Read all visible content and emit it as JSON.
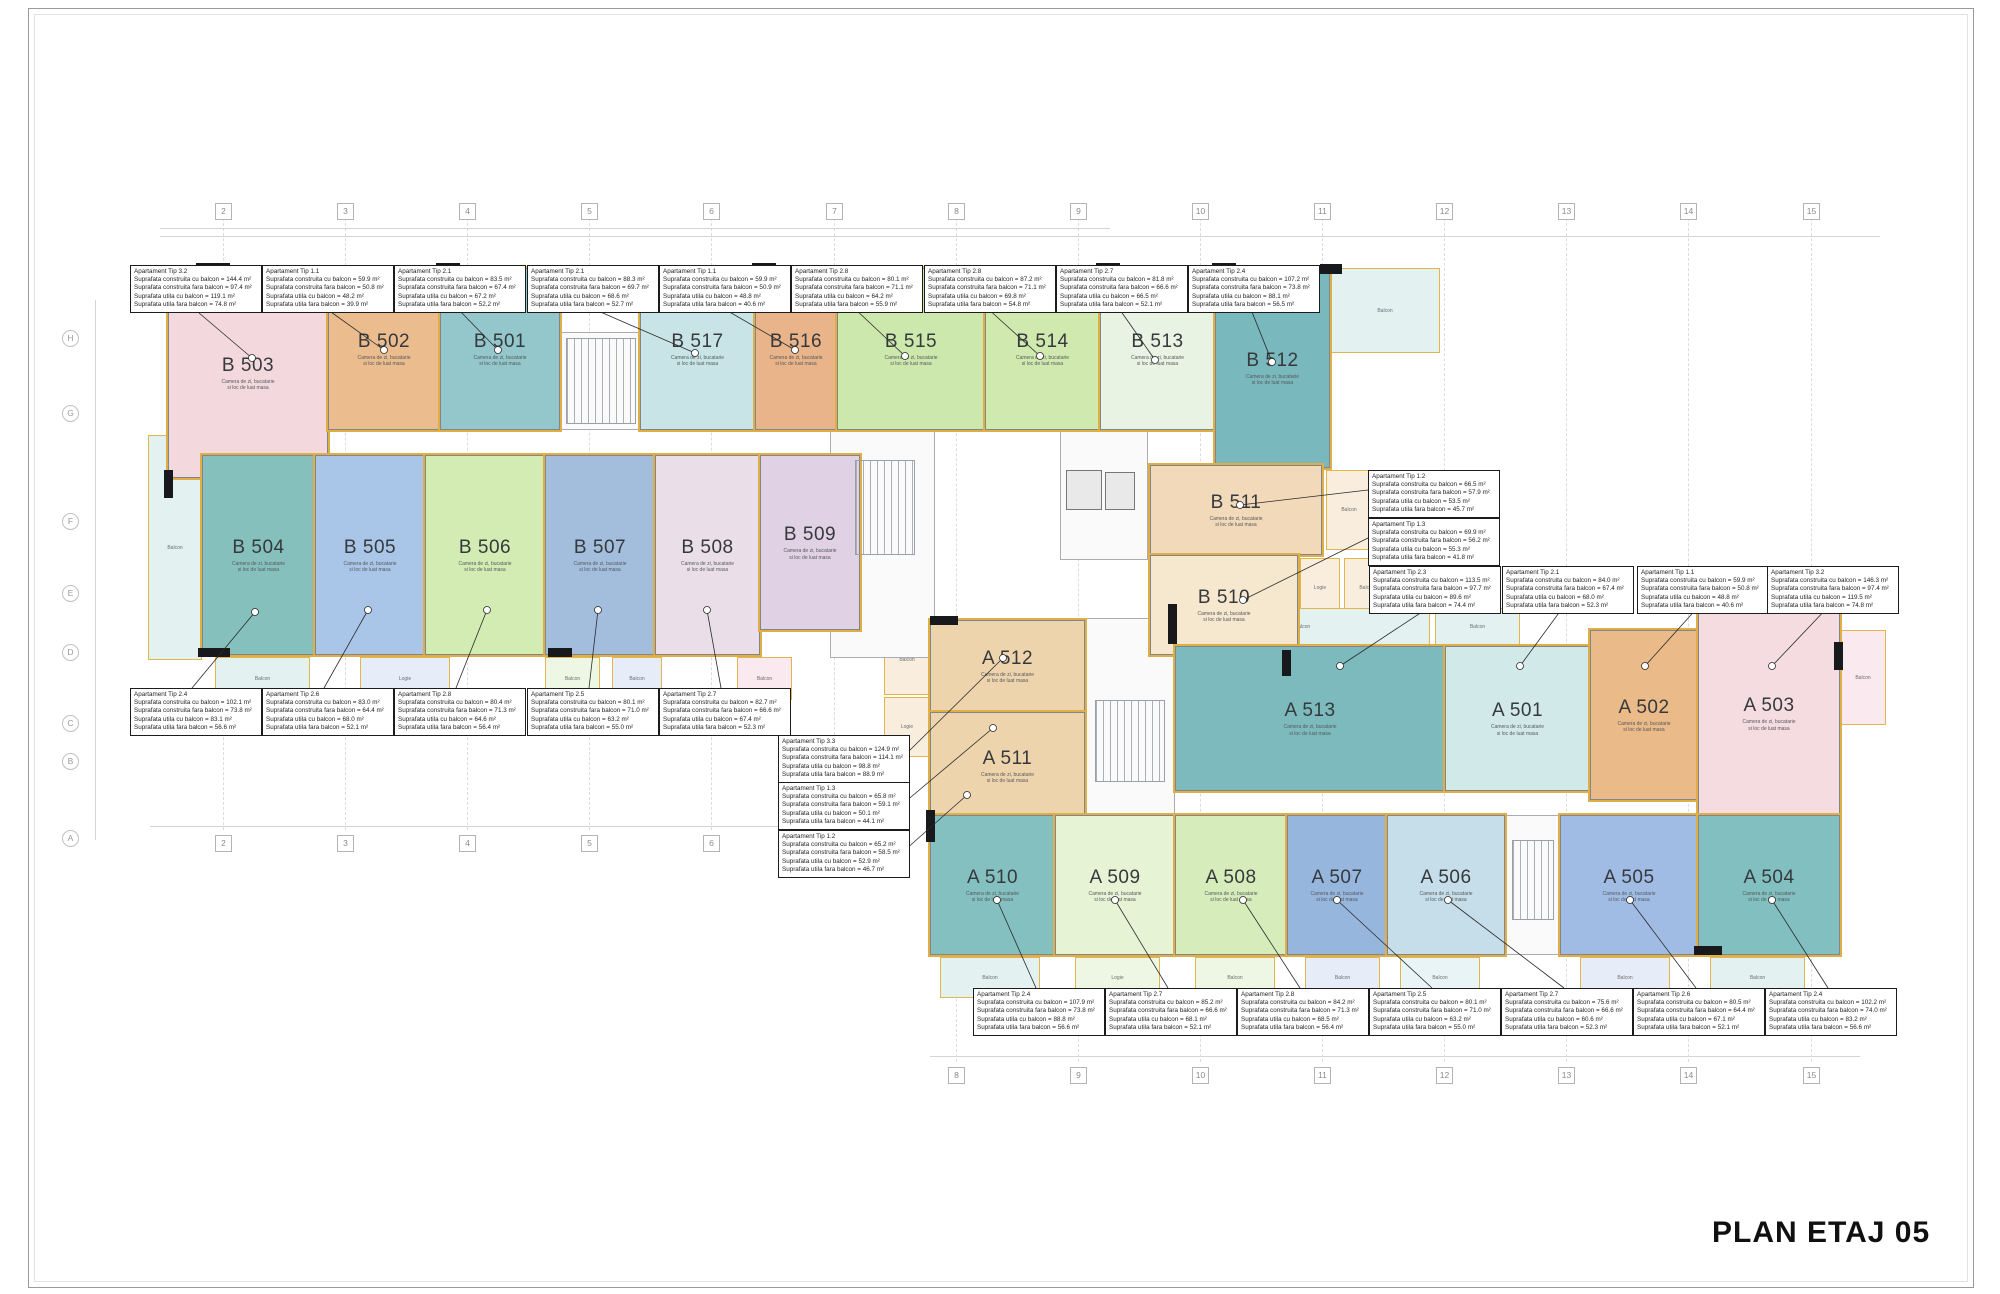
{
  "sheet": {
    "title": "PLAN ETAJ 05"
  },
  "grid": {
    "columns": [
      "2",
      "3",
      "4",
      "5",
      "6",
      "7",
      "8",
      "9",
      "10",
      "11",
      "12",
      "13",
      "14",
      "15"
    ],
    "rows": [
      "H",
      "G",
      "F",
      "E",
      "D",
      "C",
      "B",
      "A"
    ]
  },
  "captions": {
    "living": "Camera de zi, bucatarie\nsi loc de luat masa",
    "balcon": "Balcon",
    "logie": "Logie"
  },
  "units": {
    "b501": {
      "label": "B 501"
    },
    "b502": {
      "label": "B 502"
    },
    "b503": {
      "label": "B 503"
    },
    "b504": {
      "label": "B 504"
    },
    "b505": {
      "label": "B 505"
    },
    "b506": {
      "label": "B 506"
    },
    "b507": {
      "label": "B 507"
    },
    "b508": {
      "label": "B 508"
    },
    "b509": {
      "label": "B 509"
    },
    "b510": {
      "label": "B 510"
    },
    "b511": {
      "label": "B 511"
    },
    "b512": {
      "label": "B 512"
    },
    "b513": {
      "label": "B 513"
    },
    "b514": {
      "label": "B 514"
    },
    "b515": {
      "label": "B 515"
    },
    "b516": {
      "label": "B 516"
    },
    "b517": {
      "label": "B 517"
    },
    "a501": {
      "label": "A 501"
    },
    "a502": {
      "label": "A 502"
    },
    "a503": {
      "label": "A 503"
    },
    "a504": {
      "label": "A 504"
    },
    "a505": {
      "label": "A 505"
    },
    "a506": {
      "label": "A 506"
    },
    "a507": {
      "label": "A 507"
    },
    "a508": {
      "label": "A 508"
    },
    "a509": {
      "label": "A 509"
    },
    "a510": {
      "label": "A 510"
    },
    "a511": {
      "label": "A 511"
    },
    "a512": {
      "label": "A 512"
    },
    "a513": {
      "label": "A 513"
    }
  },
  "annotations": {
    "top": [
      {
        "type": "Apartament Tip 3.2",
        "lines": [
          "Suprafata construita cu balcon = 144.4 m²",
          "Suprafata construita fara balcon = 97.4 m²",
          "Suprafata utila cu balcon = 119.1 m²",
          "Suprafata utila fara balcon = 74.8 m²"
        ]
      },
      {
        "type": "Apartament Tip 1.1",
        "lines": [
          "Suprafata construita cu balcon = 59.9 m²",
          "Suprafata construita fara balcon = 50.8 m²",
          "Suprafata utila cu balcon = 48.2 m²",
          "Suprafata utila fara balcon = 39.9 m²"
        ]
      },
      {
        "type": "Apartament Tip 2.1",
        "lines": [
          "Suprafata construita cu balcon = 83.5 m²",
          "Suprafata construita fara balcon = 67.4 m²",
          "Suprafata utila cu balcon = 67.2 m²",
          "Suprafata utila fara balcon = 52.2 m²"
        ]
      },
      {
        "type": "Apartament Tip 2.1",
        "lines": [
          "Suprafata construita cu balcon = 88.3 m²",
          "Suprafata construita fara balcon = 69.7 m²",
          "Suprafata utila cu balcon = 68.6 m²",
          "Suprafata utila fara balcon = 52.7 m²"
        ]
      },
      {
        "type": "Apartament Tip 1.1",
        "lines": [
          "Suprafata construita cu balcon = 59.9 m²",
          "Suprafata construita fara balcon = 50.9 m²",
          "Suprafata utila cu balcon = 48.8 m²",
          "Suprafata utila fara balcon = 40.6 m²"
        ]
      },
      {
        "type": "Apartament Tip 2.8",
        "lines": [
          "Suprafata construita cu balcon = 80.1 m²",
          "Suprafata construita fara balcon = 71.1 m²",
          "Suprafata utila cu balcon = 64.2 m²",
          "Suprafata utila fara balcon = 55.9 m²"
        ]
      },
      {
        "type": "Apartament Tip 2.8",
        "lines": [
          "Suprafata construita cu balcon = 87.2 m²",
          "Suprafata construita fara balcon = 71.1 m²",
          "Suprafata utila cu balcon = 69.8 m²",
          "Suprafata utila fara balcon = 54.8 m²"
        ]
      },
      {
        "type": "Apartament Tip 2.7",
        "lines": [
          "Suprafata construita cu balcon = 81.8 m²",
          "Suprafata construita fara balcon = 66.6 m²",
          "Suprafata utila cu balcon = 66.5 m²",
          "Suprafata utila fara balcon = 52.1 m²"
        ]
      },
      {
        "type": "Apartament Tip 2.4",
        "lines": [
          "Suprafata construita cu balcon = 107.2 m²",
          "Suprafata construita fara balcon = 73.8 m²",
          "Suprafata utila cu balcon = 88.1 m²",
          "Suprafata utila fara balcon = 56.5 m²"
        ]
      }
    ],
    "left_row": [
      {
        "type": "Apartament Tip 2.4",
        "lines": [
          "Suprafata construita cu balcon = 102.1 m²",
          "Suprafata construita fara balcon = 73.8 m²",
          "Suprafata utila cu balcon = 83.1 m²",
          "Suprafata utila fara balcon = 56.6 m²"
        ]
      },
      {
        "type": "Apartament Tip 2.6",
        "lines": [
          "Suprafata construita cu balcon = 83.0 m²",
          "Suprafata construita fara balcon = 64.4 m²",
          "Suprafata utila cu balcon = 68.0 m²",
          "Suprafata utila fara balcon = 52.1 m²"
        ]
      },
      {
        "type": "Apartament Tip 2.8",
        "lines": [
          "Suprafata construita cu balcon = 80.4 m²",
          "Suprafata construita fara balcon = 71.3 m²",
          "Suprafata utila cu balcon = 64.6 m²",
          "Suprafata utila fara balcon = 56.4 m²"
        ]
      },
      {
        "type": "Apartament Tip 2.5",
        "lines": [
          "Suprafata construita cu balcon = 80.1 m²",
          "Suprafata construita fara balcon = 71.0 m²",
          "Suprafata utila cu balcon = 63.2 m²",
          "Suprafata utila fara balcon = 55.0 m²"
        ]
      },
      {
        "type": "Apartament Tip 2.7",
        "lines": [
          "Suprafata construita cu balcon = 82.7 m²",
          "Suprafata construita fara balcon = 66.6 m²",
          "Suprafata utila cu balcon = 67.4 m²",
          "Suprafata utila fara balcon = 52.3 m²"
        ]
      }
    ],
    "center": [
      {
        "type": "Apartament Tip 3.3",
        "lines": [
          "Suprafata construita cu balcon = 124.9 m²",
          "Suprafata construita fara balcon = 114.1 m²",
          "Suprafata utila cu balcon = 98.8 m²",
          "Suprafata utila fara balcon = 88.9 m²"
        ]
      },
      {
        "type": "Apartament Tip 1.3",
        "lines": [
          "Suprafata construita cu balcon = 65.8 m²",
          "Suprafata construita fara balcon = 59.1 m²",
          "Suprafata utila cu balcon = 50.1 m²",
          "Suprafata utila fara balcon = 44.1 m²"
        ]
      },
      {
        "type": "Apartament Tip 1.2",
        "lines": [
          "Suprafata construita cu balcon = 65.2 m²",
          "Suprafata construita fara balcon = 58.5 m²",
          "Suprafata utila cu balcon = 52.9 m²",
          "Suprafata utila fara balcon = 46.7 m²"
        ]
      }
    ],
    "right_mid": [
      {
        "type": "Apartament Tip 1.2",
        "lines": [
          "Suprafata construita cu balcon = 66.5 m²",
          "Suprafata construita fara balcon = 57.9 m²",
          "Suprafata utila cu balcon = 53.5 m²",
          "Suprafata utila fara balcon = 45.7 m²"
        ]
      },
      {
        "type": "Apartament Tip 1.3",
        "lines": [
          "Suprafata construita cu balcon = 69.9 m²",
          "Suprafata construita fara balcon = 56.2 m²",
          "Suprafata utila cu balcon = 55.3 m²",
          "Suprafata utila fara balcon = 41.8 m²"
        ]
      }
    ],
    "right_row": [
      {
        "type": "Apartament Tip 2.3",
        "lines": [
          "Suprafata construita cu balcon = 113.5 m²",
          "Suprafata construita fara balcon = 97.7 m²",
          "Suprafata utila cu balcon = 89.6 m²",
          "Suprafata utila fara balcon = 74.4 m²"
        ]
      },
      {
        "type": "Apartament Tip 2.1",
        "lines": [
          "Suprafata construita cu balcon = 84.0 m²",
          "Suprafata construita fara balcon = 67.4 m²",
          "Suprafata utila cu balcon = 68.0 m²",
          "Suprafata utila fara balcon = 52.3 m²"
        ]
      },
      {
        "type": "Apartament Tip 1.1",
        "lines": [
          "Suprafata construita cu balcon = 59.9 m²",
          "Suprafata construita fara balcon = 50.8 m²",
          "Suprafata utila cu balcon = 48.8 m²",
          "Suprafata utila fara balcon = 40.6 m²"
        ]
      },
      {
        "type": "Apartament Tip 3.2",
        "lines": [
          "Suprafata construita cu balcon = 146.3 m²",
          "Suprafata construita fara balcon = 97.4 m²",
          "Suprafata utila cu balcon = 119.5 m²",
          "Suprafata utila fara balcon = 74.8 m²"
        ]
      }
    ],
    "bottom": [
      {
        "type": "Apartament Tip 2.4",
        "lines": [
          "Suprafata construita cu balcon = 107.9 m²",
          "Suprafata construita fara balcon = 73.8 m²",
          "Suprafata utila cu balcon = 88.8 m²",
          "Suprafata utila fara balcon = 56.6 m²"
        ]
      },
      {
        "type": "Apartament Tip 2.7",
        "lines": [
          "Suprafata construita cu balcon = 85.2 m²",
          "Suprafata construita fara balcon = 66.6 m²",
          "Suprafata utila cu balcon = 68.1 m²",
          "Suprafata utila fara balcon = 52.1 m²"
        ]
      },
      {
        "type": "Apartament Tip 2.8",
        "lines": [
          "Suprafata construita cu balcon = 84.2 m²",
          "Suprafata construita fara balcon = 71.3 m²",
          "Suprafata utila cu balcon = 68.5 m²",
          "Suprafata utila fara balcon = 56.4 m²"
        ]
      },
      {
        "type": "Apartament Tip 2.5",
        "lines": [
          "Suprafata construita cu balcon = 80.1 m²",
          "Suprafata construita fara balcon = 71.0 m²",
          "Suprafata utila cu balcon = 63.2 m²",
          "Suprafata utila fara balcon = 55.0 m²"
        ]
      },
      {
        "type": "Apartament Tip 2.7",
        "lines": [
          "Suprafata construita cu balcon = 75.6 m²",
          "Suprafata construita fara balcon = 66.6 m²",
          "Suprafata utila cu balcon = 60.6 m²",
          "Suprafata utila fara balcon = 52.3 m²"
        ]
      },
      {
        "type": "Apartament Tip 2.6",
        "lines": [
          "Suprafata construita cu balcon = 80.5 m²",
          "Suprafata construita fara balcon = 64.4 m²",
          "Suprafata utila cu balcon = 67.1 m²",
          "Suprafata utila fara balcon = 52.1 m²"
        ]
      },
      {
        "type": "Apartament Tip 2.4",
        "lines": [
          "Suprafata construita cu balcon = 102.2 m²",
          "Suprafata construita fara balcon = 74.0 m²",
          "Suprafata utila cu balcon = 83.2 m²",
          "Suprafata utila fara balcon = 56.6 m²"
        ]
      }
    ]
  }
}
